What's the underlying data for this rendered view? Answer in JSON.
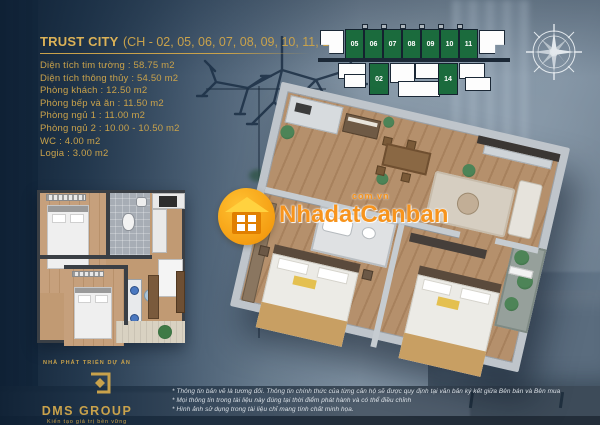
{
  "title": {
    "name": "TRUST CITY",
    "units": "(CH - 02, 05, 06, 07, 08, 09, 10, 11, 14)"
  },
  "specs": [
    "Diện tích tim tường : 58.75 m2",
    "Diện tích thông thủy : 54.50 m2",
    "Phòng khách : 12.50 m2",
    "Phòng bếp và ăn : 11.50 m2",
    "Phòng ngủ 1 : 11.00 m2",
    "Phòng ngủ 2 : 10.00 - 10.50 m2",
    "WC : 4.00 m2",
    "Logia : 3.00 m2"
  ],
  "building": {
    "top_units": [
      "05",
      "06",
      "07",
      "08",
      "09",
      "10",
      "11"
    ],
    "bottom_units": [
      "02",
      "14"
    ],
    "highlight_color": "#1b6b3d"
  },
  "watermark": {
    "name": "NhadatCanban",
    "domain": "com.vn",
    "accent_color": "#f7941d"
  },
  "developer": {
    "eyebrow": "NHÀ PHÁT TRIỂN DỰ ÁN",
    "name": "DMS GROUP",
    "tagline": "Kiến tạo giá trị bền vững",
    "brand_color": "#c9a24b"
  },
  "disclaimers": [
    "* Thông tin bản vẽ là tương đối. Thông tin chính thức của từng căn hộ sẽ được quy định tại văn bản ký kết giữa Bên bán và Bên mua",
    "* Mọi thông tin trong tài liệu này đúng tại thời điểm phát hành và có thể điều chỉnh",
    "* Hình ảnh sử dụng trong tài liệu chỉ mang tính chất minh họa."
  ],
  "icons": {
    "compass": "compass-rose",
    "watermark_logo": "house-in-orange-circle",
    "developer_logo": "gold-square-diamond"
  }
}
